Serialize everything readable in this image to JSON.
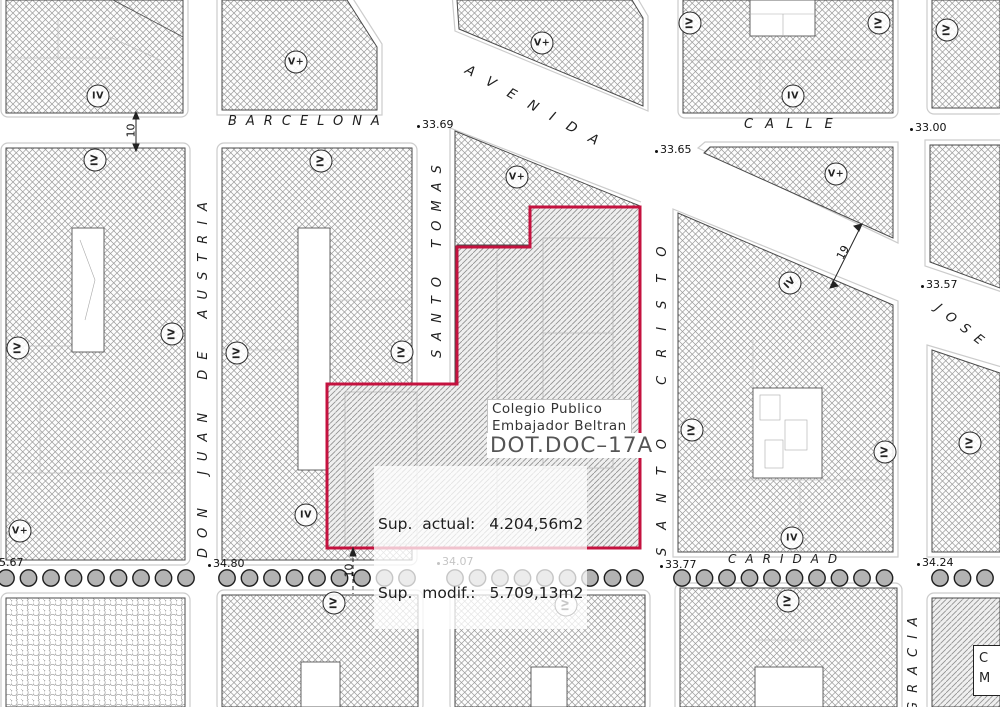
{
  "map": {
    "colors": {
      "parcel_outline": "#c4123f",
      "hatch_line": "#9a9a9a",
      "tree_fill": "#b3b3b3",
      "kerb": "#cccccc",
      "block_border": "#4a4a4a"
    },
    "streets": [
      {
        "name": "BARCELONA",
        "x": 228,
        "y": 114,
        "rot": 0,
        "fs": 13,
        "ls": 9,
        "ws": 0
      },
      {
        "name": "AVENIDA",
        "x": 470,
        "y": 62,
        "rot": 29,
        "fs": 13.5,
        "ls": 15,
        "ws": 0
      },
      {
        "name": "CALLE",
        "x": 744,
        "y": 117,
        "rot": 0,
        "fs": 13,
        "ls": 12,
        "ws": 0
      },
      {
        "name": "CARIDAD",
        "x": 728,
        "y": 552,
        "rot": 0,
        "fs": 12,
        "ls": 9,
        "ws": 0
      },
      {
        "name": "DON JUAN DE AUSTRIA",
        "x": 196,
        "y": 558,
        "rot": -90,
        "fs": 13,
        "ls": 10,
        "ws": 9
      },
      {
        "name": "SANTO TOMAS",
        "x": 430,
        "y": 358,
        "rot": -90,
        "fs": 13,
        "ls": 9,
        "ws": 7
      },
      {
        "name": "SANTO CRISTO",
        "x": 655,
        "y": 556,
        "rot": -90,
        "fs": 13,
        "ls": 18,
        "ws": 14
      },
      {
        "name": "GRACIA",
        "x": 906,
        "y": 712,
        "rot": -90,
        "fs": 13,
        "ls": 9,
        "ws": 0
      },
      {
        "name": "JOSE",
        "x": 941,
        "y": 301,
        "rot": 38,
        "fs": 13,
        "ls": 9,
        "ws": 0
      }
    ],
    "elevations": [
      {
        "label": "33.69",
        "x": 417,
        "y": 127
      },
      {
        "label": "33.65",
        "x": 655,
        "y": 152
      },
      {
        "label": "33.00",
        "x": 910,
        "y": 130
      },
      {
        "label": "33.57",
        "x": 921,
        "y": 287
      },
      {
        "label": "5.67",
        "x": -6,
        "y": 565
      },
      {
        "label": "34.80",
        "x": 208,
        "y": 566
      },
      {
        "label": "34.07",
        "x": 437,
        "y": 564
      },
      {
        "label": "33.77",
        "x": 660,
        "y": 567
      },
      {
        "label": "34.24",
        "x": 917,
        "y": 565
      }
    ],
    "dimensions": [
      {
        "label": "10",
        "x": 124,
        "y": 124,
        "rot": -90
      },
      {
        "label": "10",
        "x": 342,
        "y": 564,
        "rot": -90
      },
      {
        "label": "19",
        "x": 836,
        "y": 246,
        "rot": -62
      }
    ],
    "circled_labels": [
      {
        "text": "IV",
        "x": 98,
        "y": 96,
        "rot": 0
      },
      {
        "text": "V+",
        "x": 296,
        "y": 62,
        "rot": 0
      },
      {
        "text": "V+",
        "x": 542,
        "y": 43,
        "rot": 0
      },
      {
        "text": "IV",
        "x": 690,
        "y": 23,
        "rot": -90
      },
      {
        "text": "IV",
        "x": 879,
        "y": 23,
        "rot": -90
      },
      {
        "text": "IV",
        "x": 947,
        "y": 30,
        "rot": -90
      },
      {
        "text": "IV",
        "x": 793,
        "y": 96,
        "rot": 0
      },
      {
        "text": "IV",
        "x": 95,
        "y": 160,
        "rot": -90
      },
      {
        "text": "IV",
        "x": 321,
        "y": 161,
        "rot": -90
      },
      {
        "text": "V+",
        "x": 836,
        "y": 174,
        "rot": 0
      },
      {
        "text": "V+",
        "x": 517,
        "y": 177,
        "rot": 0
      },
      {
        "text": "IV",
        "x": 18,
        "y": 348,
        "rot": -90
      },
      {
        "text": "IV",
        "x": 172,
        "y": 334,
        "rot": -90
      },
      {
        "text": "IV",
        "x": 237,
        "y": 353,
        "rot": -90
      },
      {
        "text": "IV",
        "x": 402,
        "y": 352,
        "rot": -90
      },
      {
        "text": "IV",
        "x": 790,
        "y": 283,
        "rot": -45
      },
      {
        "text": "IV",
        "x": 692,
        "y": 430,
        "rot": -90
      },
      {
        "text": "IV",
        "x": 885,
        "y": 452,
        "rot": -90
      },
      {
        "text": "IV",
        "x": 970,
        "y": 443,
        "rot": -90
      },
      {
        "text": "V+",
        "x": 20,
        "y": 531,
        "rot": 0
      },
      {
        "text": "IV",
        "x": 306,
        "y": 515,
        "rot": 0
      },
      {
        "text": "IV",
        "x": 792,
        "y": 538,
        "rot": 0
      },
      {
        "text": "IV",
        "x": 334,
        "y": 603,
        "rot": -90
      },
      {
        "text": "IV",
        "x": 566,
        "y": 605,
        "rot": -90
      },
      {
        "text": "IV",
        "x": 788,
        "y": 601,
        "rot": -90
      }
    ],
    "trees": {
      "cy": 578,
      "r": 8.2,
      "gap": 22.5,
      "segments": [
        {
          "start": 6,
          "count": 9
        },
        {
          "start": 227,
          "count": 9
        },
        {
          "start": 455,
          "count": 9
        },
        {
          "start": 682,
          "count": 10
        },
        {
          "start": 940,
          "count": 3
        }
      ]
    },
    "parcel": {
      "title_line1": "Colegio  Publico",
      "title_line2": "Embajador  Beltran",
      "code": "DOT.DOC–17A",
      "sup_actual_label": "Sup.  actual:",
      "sup_actual_value": "4.204,56m2",
      "sup_modif_label": "Sup.  modif.:",
      "sup_modif_value": "5.709,13m2"
    },
    "corner_box": {
      "line1": "C",
      "line2": "M"
    }
  }
}
